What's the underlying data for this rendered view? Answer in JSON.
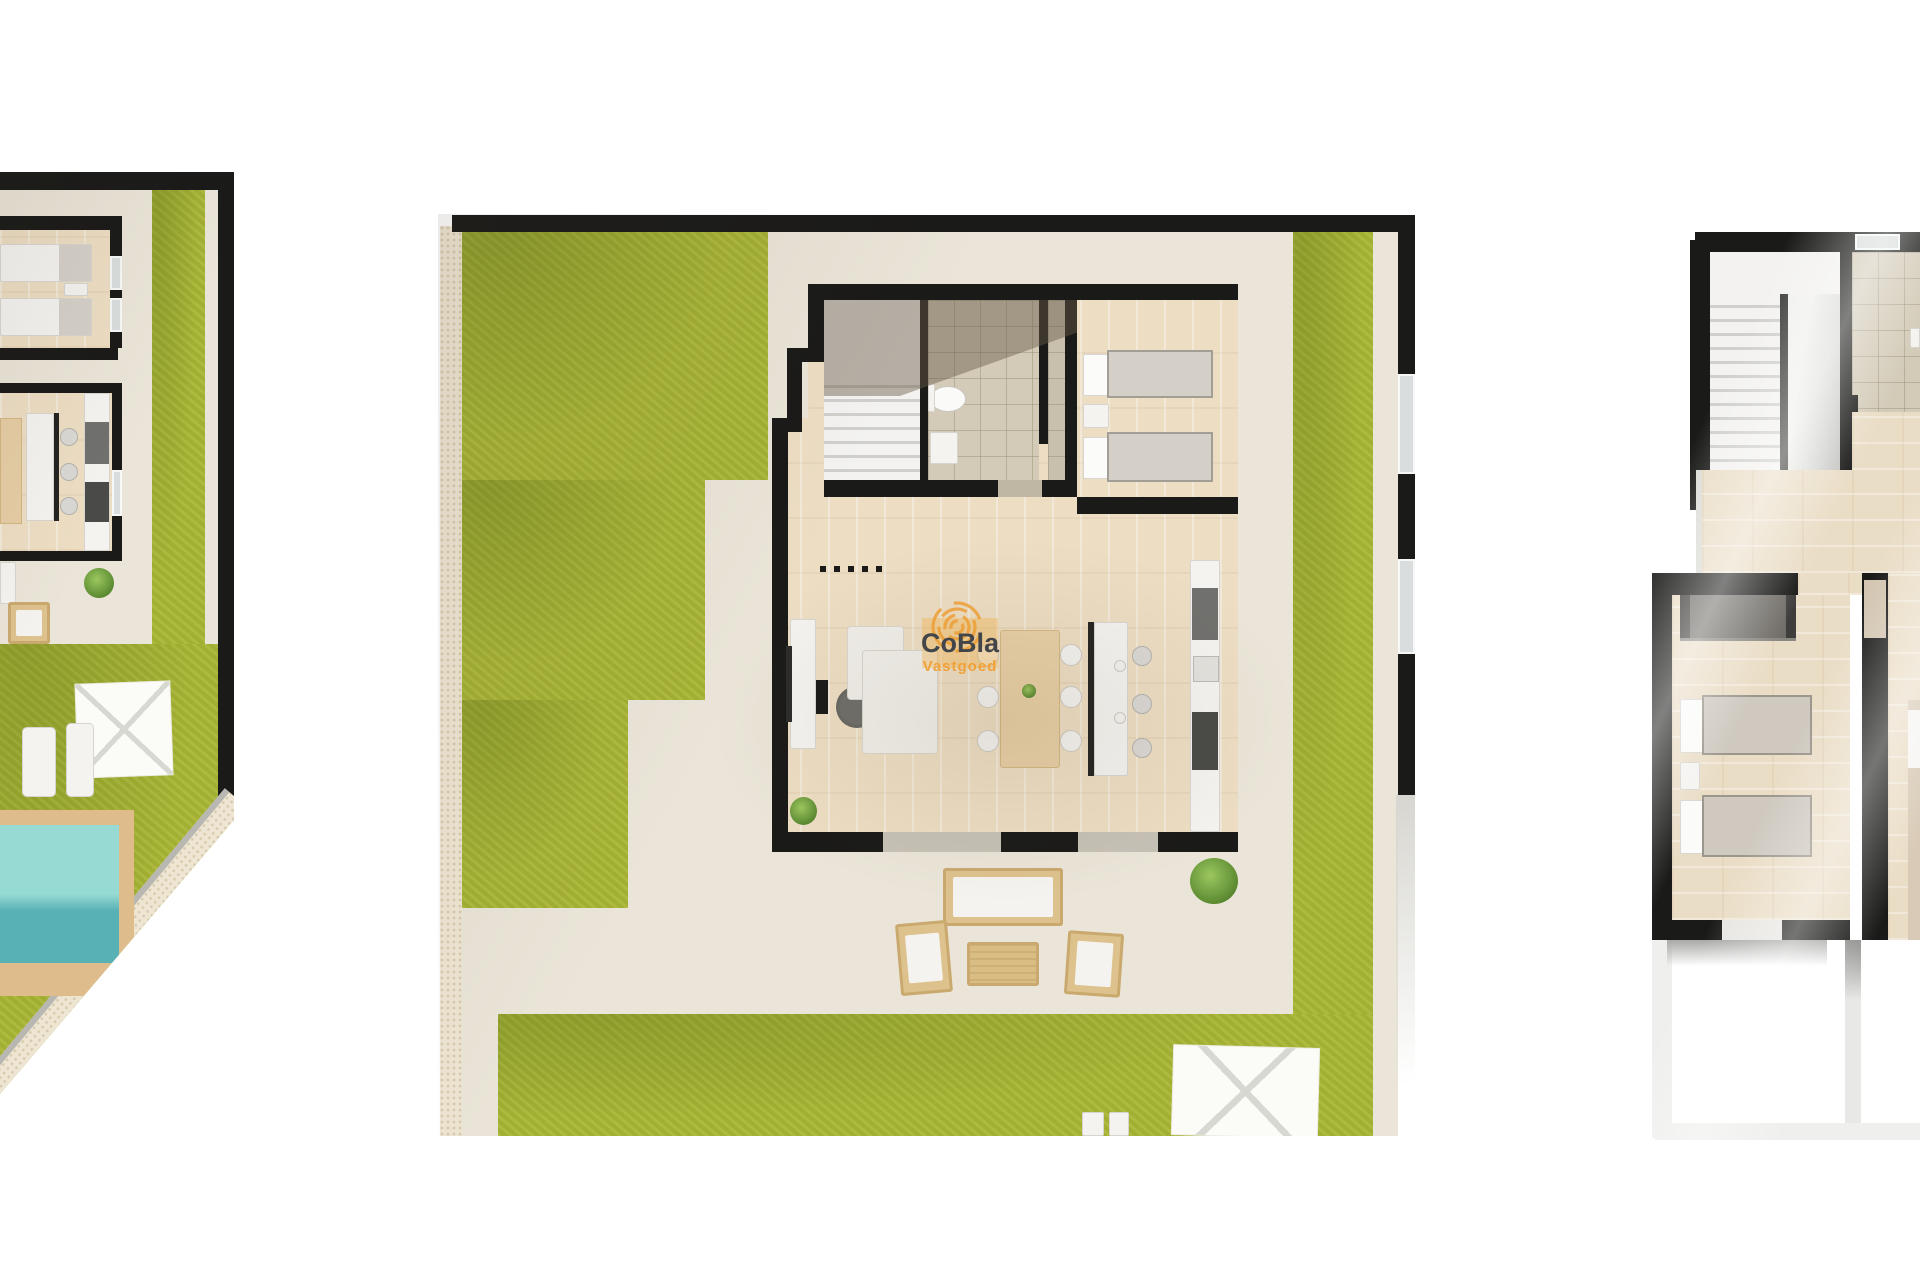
{
  "watermark": {
    "title": "CoBla",
    "subtitle": "Vastgoed",
    "title_color": "#42464b",
    "accent_color": "#f0a23a"
  },
  "colors": {
    "background": "#ffffff",
    "wall_black": "#1a1a19",
    "grass_green": "#a9b635",
    "terrace_beige": "#eae5d8",
    "wood_floor": "#ecddc3",
    "tile_taupe": "#d3cbb8",
    "stone_wall": "#eee6d3",
    "pool_water_top": "#97dad4",
    "pool_water_bottom": "#58b2b5",
    "pool_deck": "#debc8c",
    "rattan_furniture": "#ddc28e",
    "parasol_white": "#fbfbf8",
    "stairs_white": "#f3f2f0"
  }
}
